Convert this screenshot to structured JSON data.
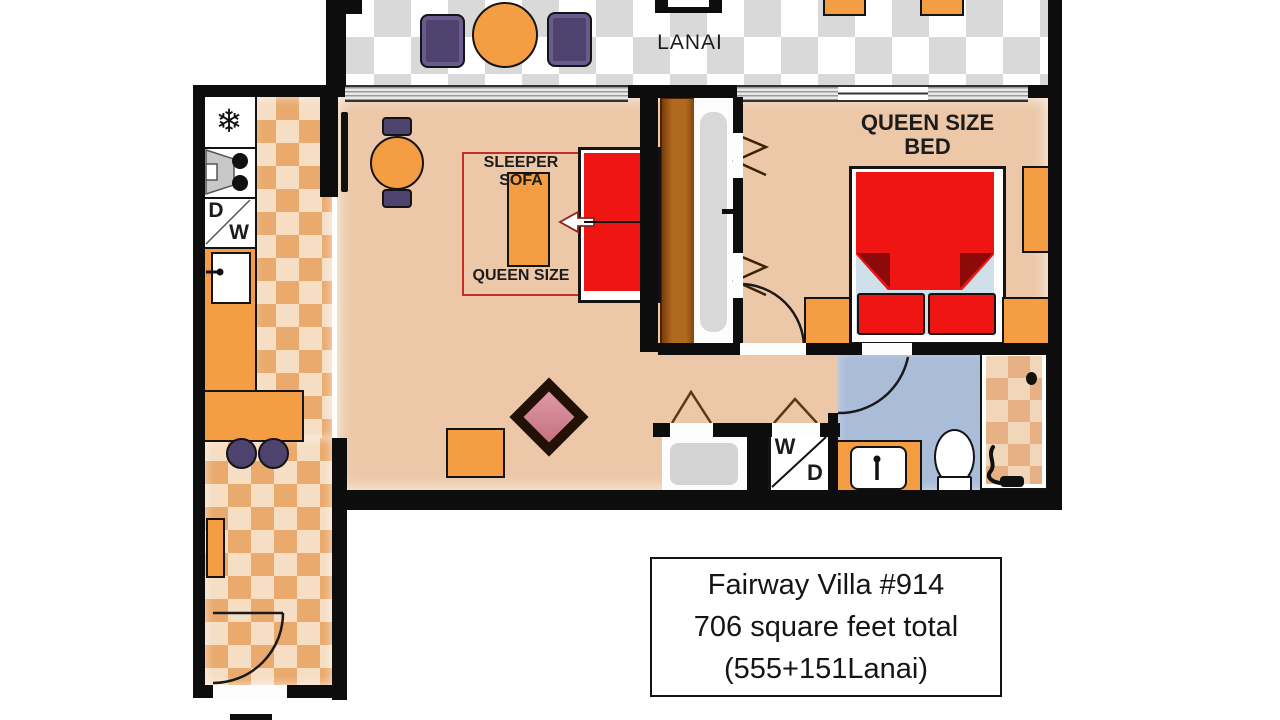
{
  "title": "Fairway Villa floor plan",
  "labels": {
    "lanai": "LANAI",
    "bedroom_line1": "QUEEN SIZE",
    "bedroom_line2": "BED",
    "sleeper_sofa": "SLEEPER SOFA",
    "sleeper_size": "QUEEN SIZE"
  },
  "appliances": {
    "refrigerator_icon": "❄",
    "dishwasher_letter_top": "D",
    "dishwasher_letter_bottom": "W",
    "washer_dryer_letter_top": "W",
    "washer_dryer_letter_bottom": "D"
  },
  "info_box": {
    "line1": "Fairway Villa #914",
    "line2": "706 square feet total",
    "line3": "(555+151Lanai)"
  },
  "colors": {
    "wall": "#0d0d0d",
    "floor_tan": "#ecc8a8",
    "kitchen_tile_dark": "#eaaa6e",
    "kitchen_tile_light": "#f6dec5",
    "lanai_tile": "#d9d9d9",
    "furniture_orange": "#f59d42",
    "accent_red": "#ee1512",
    "fold_dark_red": "#8c0a0a",
    "chair_purple": "#4e436e",
    "bathroom_blue": "#aabdd8",
    "closet_brown": "#b06a20",
    "sheet_blue": "#cfe0ea"
  }
}
